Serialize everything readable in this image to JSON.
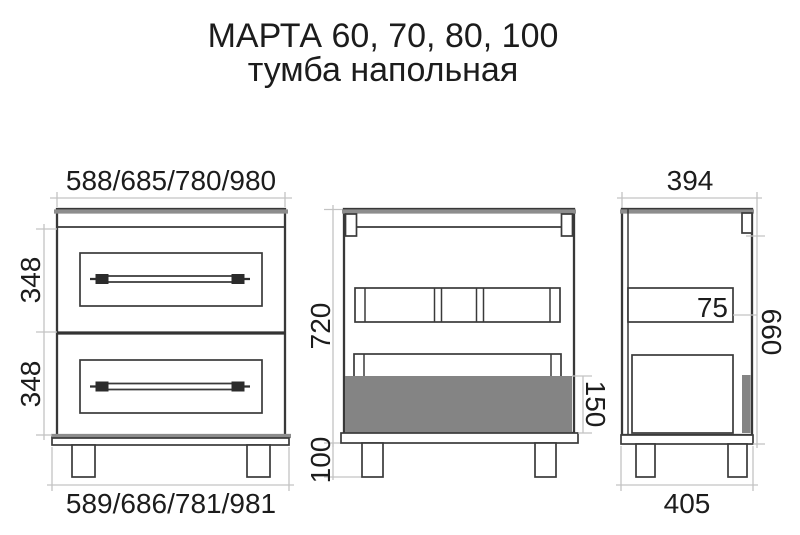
{
  "title": {
    "line1": "МАРТА 60, 70, 80, 100",
    "line2": "тумба напольная"
  },
  "front_view": {
    "width_top": "588/685/780/980",
    "width_bottom": "589/686/781/981",
    "drawer_upper_height": "348",
    "drawer_lower_height": "348"
  },
  "back_view": {
    "body_height": "720",
    "drawer_front_height": "150",
    "leg_height": "100"
  },
  "side_view": {
    "depth_top": "394",
    "depth_bottom": "405",
    "rail_height": "75",
    "side_panel_height": "660"
  },
  "colors": {
    "line_dark": "#3a3a3a",
    "edge_gray": "#8d8d8d",
    "dimension_gray": "#c3c3c3",
    "drawer_box_gray": "#848484",
    "background": "#ffffff",
    "text": "#1c1c1c"
  }
}
